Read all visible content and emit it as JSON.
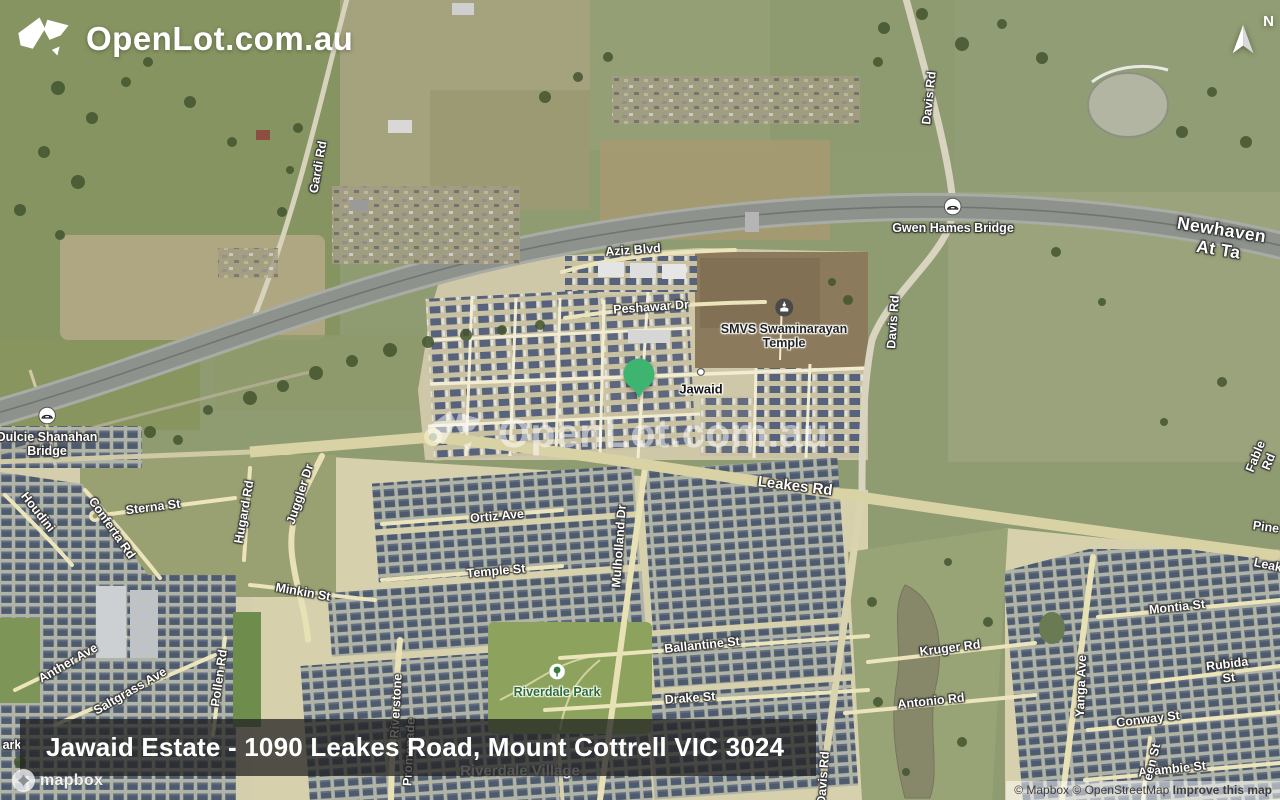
{
  "brand": {
    "name": "OpenLot.com.au"
  },
  "watermark": {
    "name": "OpenLot.com.au"
  },
  "compass": {
    "label": "N"
  },
  "banner": {
    "title": "Jawaid Estate - 1090 Leakes Road, Mount Cottrell VIC 3024"
  },
  "marker": {
    "location": "Jawaid Estate",
    "color": "#3db470"
  },
  "attribution": {
    "mapbox": "© Mapbox",
    "osm": "© OpenStreetMap",
    "improve": "Improve this map",
    "logo_text": "mapbox"
  },
  "map": {
    "type": "satellite",
    "labels": [
      {
        "text": "Gardi Rd",
        "x": 318,
        "y": 167,
        "rot": -80,
        "cls": "road"
      },
      {
        "text": "Davis Rd",
        "x": 929,
        "y": 98,
        "rot": -84,
        "cls": "road"
      },
      {
        "text": "Gwen Hames Bridge",
        "x": 953,
        "y": 216,
        "rot": 0,
        "cls": "road",
        "icon": "bridge"
      },
      {
        "text": "Newhaven At Ta",
        "x": 1220,
        "y": 240,
        "rot": 9,
        "cls": "hwy"
      },
      {
        "text": "Aziz Blvd",
        "x": 633,
        "y": 250,
        "rot": -4,
        "cls": "road"
      },
      {
        "text": "Peshawar Dr",
        "x": 651,
        "y": 307,
        "rot": -4,
        "cls": "road"
      },
      {
        "text": "SMVS Swaminarayan\nTemple",
        "x": 784,
        "y": 324,
        "rot": 0,
        "cls": "poi",
        "icon": "temple"
      },
      {
        "text": "Davis Rd",
        "x": 893,
        "y": 322,
        "rot": -86,
        "cls": "road"
      },
      {
        "text": "Jawaid",
        "x": 701,
        "y": 381,
        "rot": 0,
        "cls": "place",
        "icon": "dot"
      },
      {
        "text": "Dulcie Shanahan\nBridge",
        "x": 47,
        "y": 432,
        "rot": 0,
        "cls": "road",
        "icon": "bridge"
      },
      {
        "text": "Leakes Rd",
        "x": 795,
        "y": 487,
        "rot": 7,
        "cls": "main"
      },
      {
        "text": "Sterna St",
        "x": 153,
        "y": 507,
        "rot": -7,
        "cls": "road"
      },
      {
        "text": "Conferta Rd",
        "x": 112,
        "y": 528,
        "rot": 55,
        "cls": "road"
      },
      {
        "text": "Houdini",
        "x": 38,
        "y": 512,
        "rot": 52,
        "cls": "road"
      },
      {
        "text": "Hugard Rd",
        "x": 244,
        "y": 512,
        "rot": -80,
        "cls": "road"
      },
      {
        "text": "Juggler Dr",
        "x": 300,
        "y": 494,
        "rot": -72,
        "cls": "road"
      },
      {
        "text": "Minkin St",
        "x": 303,
        "y": 592,
        "rot": 10,
        "cls": "road"
      },
      {
        "text": "Ortiz Ave",
        "x": 497,
        "y": 516,
        "rot": -5,
        "cls": "road"
      },
      {
        "text": "Temple St",
        "x": 496,
        "y": 571,
        "rot": -5,
        "cls": "road"
      },
      {
        "text": "Mulholland Dr",
        "x": 619,
        "y": 546,
        "rot": -86,
        "cls": "road"
      },
      {
        "text": "Ballantine St",
        "x": 702,
        "y": 645,
        "rot": -6,
        "cls": "road"
      },
      {
        "text": "Drake St",
        "x": 690,
        "y": 698,
        "rot": -4,
        "cls": "road"
      },
      {
        "text": "Riverdale Park",
        "x": 557,
        "y": 681,
        "rot": 0,
        "cls": "park",
        "icon": "tree"
      },
      {
        "text": "Riverdale Village",
        "x": 520,
        "y": 772,
        "rot": 0,
        "cls": "village"
      },
      {
        "text": "Riverstone",
        "x": 396,
        "y": 706,
        "rot": -87,
        "cls": "road"
      },
      {
        "text": "Promenade",
        "x": 409,
        "y": 752,
        "rot": -87,
        "cls": "road"
      },
      {
        "text": "Kruger Rd",
        "x": 950,
        "y": 648,
        "rot": -7,
        "cls": "road"
      },
      {
        "text": "Antonio Rd",
        "x": 931,
        "y": 701,
        "rot": -6,
        "cls": "road"
      },
      {
        "text": "Montia St",
        "x": 1177,
        "y": 607,
        "rot": -6,
        "cls": "road"
      },
      {
        "text": "Rubida St",
        "x": 1228,
        "y": 671,
        "rot": -7,
        "cls": "road"
      },
      {
        "text": "Yanga Ave",
        "x": 1081,
        "y": 686,
        "rot": -88,
        "cls": "road"
      },
      {
        "text": "Conway St",
        "x": 1148,
        "y": 719,
        "rot": -7,
        "cls": "road"
      },
      {
        "text": "Allambie St",
        "x": 1172,
        "y": 769,
        "rot": -6,
        "cls": "road"
      },
      {
        "text": "een St",
        "x": 1152,
        "y": 762,
        "rot": -76,
        "cls": "road"
      },
      {
        "text": "Anther Ave",
        "x": 68,
        "y": 663,
        "rot": -30,
        "cls": "road"
      },
      {
        "text": "Saltgrass Ave",
        "x": 130,
        "y": 691,
        "rot": -30,
        "cls": "road"
      },
      {
        "text": "Pollen Rd",
        "x": 219,
        "y": 678,
        "rot": -82,
        "cls": "road"
      },
      {
        "text": "Davis Rd",
        "x": 823,
        "y": 778,
        "rot": -86,
        "cls": "road"
      },
      {
        "text": "Fable Rd",
        "x": 1262,
        "y": 459,
        "rot": -68,
        "cls": "road"
      },
      {
        "text": "Pine",
        "x": 1266,
        "y": 527,
        "rot": 8,
        "cls": "road"
      },
      {
        "text": "Leak",
        "x": 1268,
        "y": 565,
        "rot": 12,
        "cls": "road"
      },
      {
        "text": "ark",
        "x": 12,
        "y": 745,
        "rot": 0,
        "cls": "road"
      }
    ]
  }
}
